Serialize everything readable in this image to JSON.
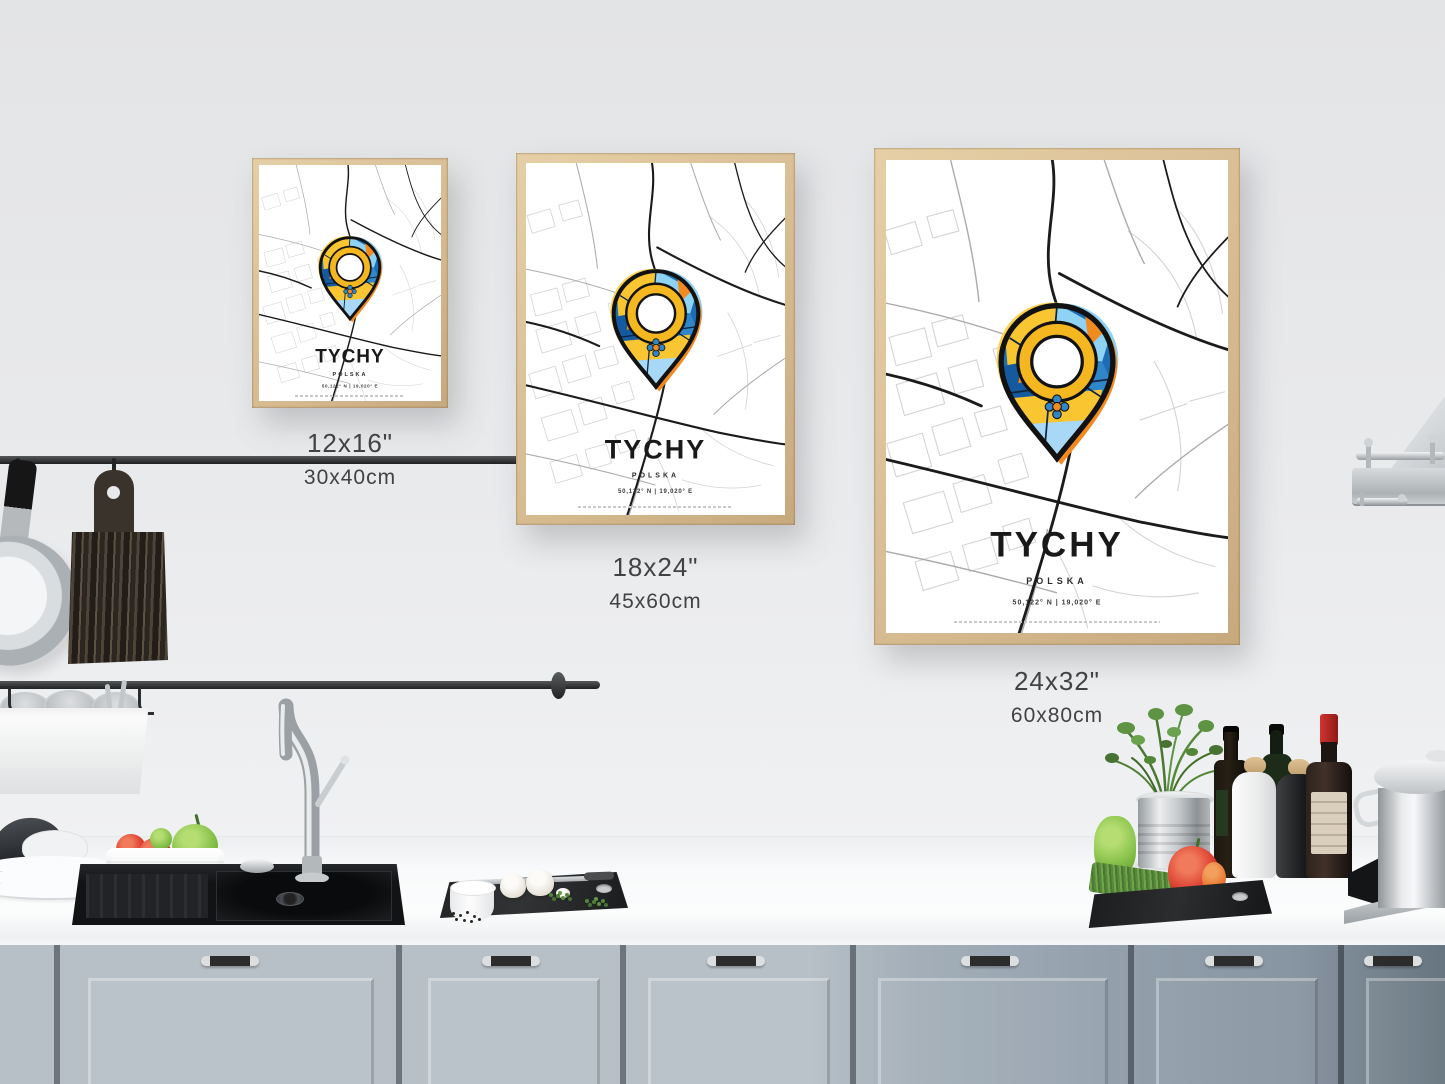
{
  "scene": {
    "kind": "kitchen product mockup photo",
    "subject": "TYCHY map art prints framed on kitchen wall"
  },
  "posters": [
    {
      "title": "TYCHY",
      "subtitle": "POLSKA",
      "coordinates": "50,122° N | 19,020° E",
      "size_inches": "12x16\"",
      "size_cm": "30x40cm"
    },
    {
      "title": "TYCHY",
      "subtitle": "POLSKA",
      "coordinates": "50,122° N | 19,020° E",
      "size_inches": "18x24\"",
      "size_cm": "45x60cm"
    },
    {
      "title": "TYCHY",
      "subtitle": "POLSKA",
      "coordinates": "50,122° N | 19,020° E",
      "size_inches": "24x32\"",
      "size_cm": "60x80cm"
    }
  ],
  "palette": {
    "wall": "#e8e9ea",
    "frame_wood": "#d7bc92",
    "pin_base_blue": "#1d6db4",
    "pin_yellow": "#f9c631",
    "pin_light_blue": "#8ed2f4",
    "pin_orange": "#f28a20",
    "pin_outline": "#121212",
    "cabinet_left": "#b7c0c7",
    "cabinet_right": "#66757f",
    "counter": "#f9fafb",
    "sink": "#131416"
  }
}
